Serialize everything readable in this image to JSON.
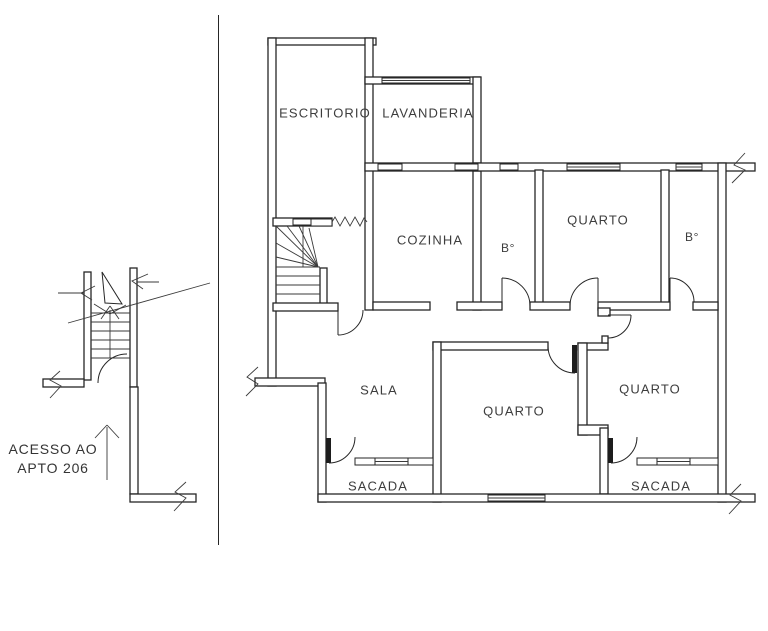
{
  "drawing": {
    "type": "apartment floor plan",
    "background": "#ffffff",
    "wall_color": "#262626",
    "text_color": "#3d3d3d"
  },
  "rooms": {
    "escritorio": {
      "label": "ESCRITORIO"
    },
    "lavanderia": {
      "label": "LAVANDERIA"
    },
    "cozinha": {
      "label": "COZINHA"
    },
    "quarto_top": {
      "label": "QUARTO"
    },
    "banheiro_left": {
      "label": "B°"
    },
    "banheiro_right": {
      "label": "B°"
    },
    "sala": {
      "label": "SALA"
    },
    "quarto_center": {
      "label": "QUARTO"
    },
    "quarto_right": {
      "label": "QUARTO"
    },
    "sacada_left": {
      "label": "SACADA"
    },
    "sacada_right": {
      "label": "SACADA"
    }
  },
  "annotation": {
    "access_line1": "ACESSO AO",
    "access_line2": "APTO 206"
  }
}
